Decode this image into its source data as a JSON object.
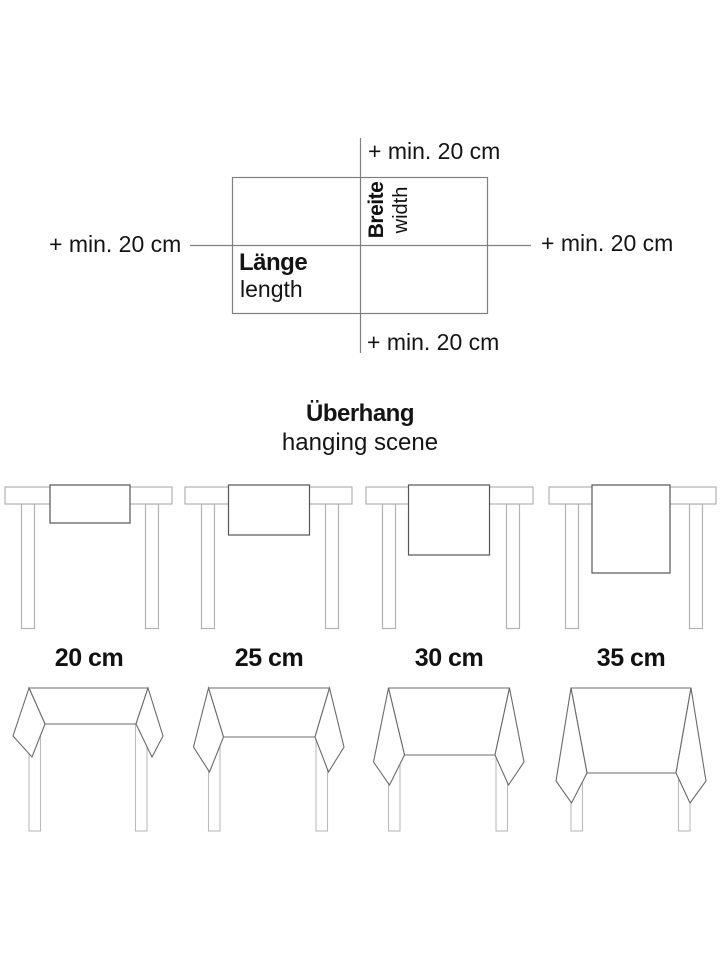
{
  "measuring_diagram": {
    "top_label": "+ min. 20 cm",
    "bottom_label": "+ min. 20 cm",
    "left_label": "+ min. 20 cm",
    "right_label": "+ min. 20 cm",
    "length_label_de": "Länge",
    "length_label_en": "length",
    "width_label_de": "Breite",
    "width_label_en": "width"
  },
  "overhang_section": {
    "title_de": "Überhang",
    "title_en": "hanging scene",
    "sizes": [
      "20 cm",
      "25 cm",
      "30 cm",
      "35 cm"
    ]
  },
  "colors": {
    "crosshair_gray": "#808080",
    "table_gray": "#b2b2b2",
    "cloth_dark": "#555555",
    "drape_gray": "#6b6b6b",
    "text": "#141414"
  }
}
